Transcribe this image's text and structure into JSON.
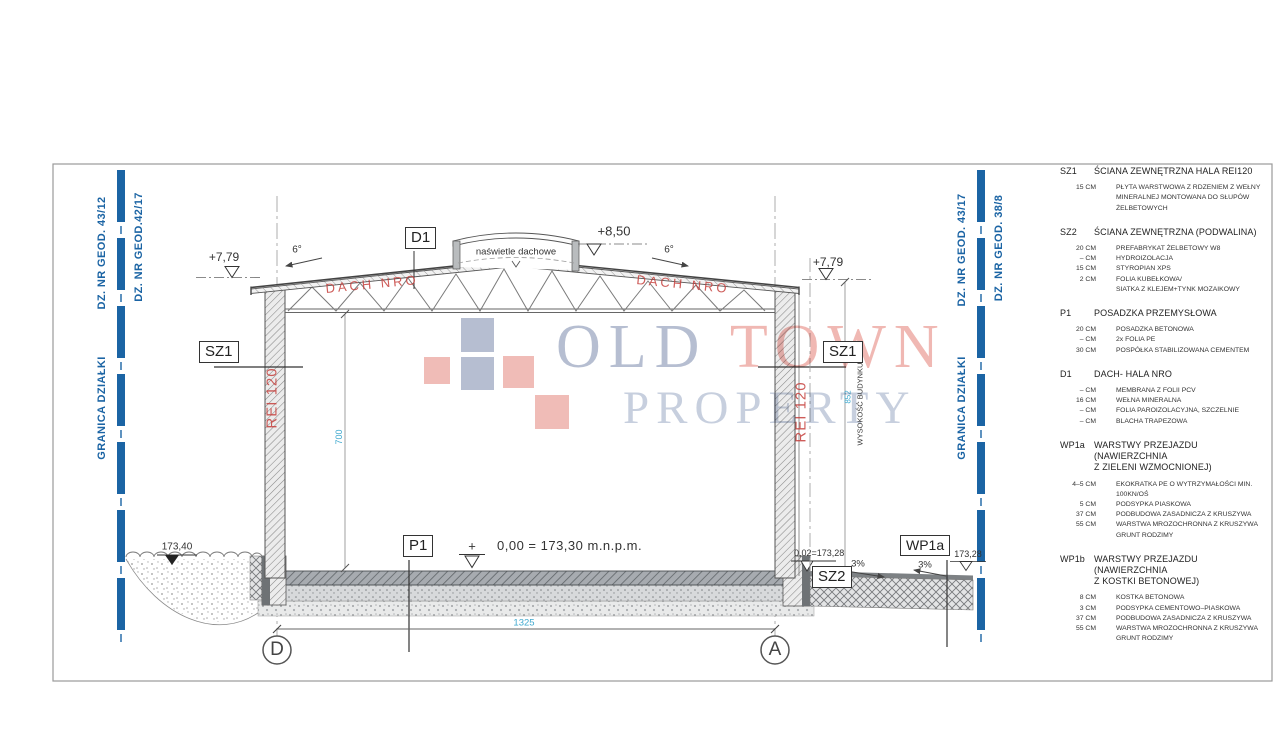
{
  "colors": {
    "boundary_blue": "#1b64a4",
    "dimension_cyan": "#3fa9cf",
    "annotation_red": "#c5403c",
    "watermark_blue": "#a9b3c9",
    "watermark_pink": "#eeaca6"
  },
  "boundaries": {
    "left": {
      "granica": "GRANICA DZIAŁKI",
      "parcel_a": "DZ. NR GEOD. 43/12",
      "parcel_b": "DZ. NR GEOD.42/17"
    },
    "right": {
      "granica": "GRANICA DZIAŁKI",
      "parcel_a": "DZ. NR GEOD. 43/17",
      "parcel_b": "DZ. NR GEOD. 38/8"
    }
  },
  "section": {
    "skylight": "naświetle dachowe",
    "ridge_level": "+8,50",
    "eave_level_left": "+7,79",
    "eave_level_right": "+7,79",
    "roof_slope_left": "6°",
    "roof_slope_right": "6°",
    "roof_label_left": "DACH NRO",
    "roof_label_right": "DACH NRO",
    "wall_fire_left": "REI 120",
    "wall_fire_right": "REI 120",
    "tag_d1": "D1",
    "tag_sz1_left": "SZ1",
    "tag_sz1_right": "SZ1",
    "tag_p1": "P1",
    "tag_sz2": "SZ2",
    "tag_wp1a": "WP1a",
    "floor_plus": "+",
    "floor_level": "0,00 = 173,30 m.n.p.m.",
    "grade_left": "173,40",
    "grade_right_wall": "0,02=173,28",
    "grade_right_edge": "173,28",
    "drive_slope_1": "3%",
    "drive_slope_2": "3%",
    "dim_clear_height": "700",
    "dim_building_height": "852",
    "dim_building_height_label": "WYSOKOŚĆ BUDYNKU",
    "dim_width": "1325",
    "grid_left": "D",
    "grid_right": "A"
  },
  "watermark": {
    "word1": "OLD",
    "word2": "TOWN",
    "line2": "PROPERTY"
  },
  "legend": {
    "sections": [
      {
        "id": "SZ1",
        "title": "ŚCIANA ZEWNĘTRZNA HALA REI120",
        "rows": [
          {
            "cm": "15 CM",
            "desc": "PŁYTA WARSTWOWA Z RDZENIEM Z WEŁNY\nMINERALNEJ MONTOWANA DO SŁUPÓW\nŻELBETOWYCH"
          }
        ]
      },
      {
        "id": "SZ2",
        "title": "ŚCIANA ZEWNĘTRZNA (PODWALINA)",
        "rows": [
          {
            "cm": "20 CM",
            "desc": "PREFABRYKAT ŻELBETOWY W8"
          },
          {
            "cm": "– CM",
            "desc": "HYDROIZOLACJA"
          },
          {
            "cm": "15 CM",
            "desc": "STYROPIAN XPS"
          },
          {
            "cm": "2 CM",
            "desc": "FOLIA KUBEŁKOWA/\nSIATKA Z KLEJEM+TYNK MOZAIKOWY"
          }
        ]
      },
      {
        "id": "P1",
        "title": "POSADZKA PRZEMYSŁOWA",
        "rows": [
          {
            "cm": "20 CM",
            "desc": "POSADZKA BETONOWA"
          },
          {
            "cm": "– CM",
            "desc": "2x FOLIA PE"
          },
          {
            "cm": "30 CM",
            "desc": "POSPÓŁKA STABILIZOWANA CEMENTEM"
          }
        ]
      },
      {
        "id": "D1",
        "title": "DACH- HALA NRO",
        "rows": [
          {
            "cm": "– CM",
            "desc": "MEMBRANA Z FOLII PCV"
          },
          {
            "cm": "16 CM",
            "desc": "WEŁNA MINERALNA"
          },
          {
            "cm": "– CM",
            "desc": "FOLIA PAROIZOLACYJNA, SZCZELNIE"
          },
          {
            "cm": "– CM",
            "desc": "BLACHA TRAPEZOWA"
          }
        ]
      },
      {
        "id": "WP1a",
        "title": "WARSTWY PRZEJAZDU (NAWIERZCHNIA\nZ ZIELENI WZMOCNIONEJ)",
        "rows": [
          {
            "cm": "4–5 CM",
            "desc": "EKOKRATKA PE O WYTRZYMAŁOŚCI MIN. 100KN/OŚ"
          },
          {
            "cm": "5 CM",
            "desc": "PODSYPKA PIASKOWA"
          },
          {
            "cm": "37 CM",
            "desc": "PODBUDOWA ZASADNICZA Z KRUSZYWA"
          },
          {
            "cm": "55 CM",
            "desc": "WARSTWA MROZOCHRONNA Z KRUSZYWA\nGRUNT RODZIMY"
          }
        ]
      },
      {
        "id": "WP1b",
        "title": "WARSTWY PRZEJAZDU (NAWIERZCHNIA\nZ KOSTKI BETONOWEJ)",
        "rows": [
          {
            "cm": "8 CM",
            "desc": "KOSTKA BETONOWA"
          },
          {
            "cm": "3 CM",
            "desc": "PODSYPKA CEMENTOWO–PIASKOWA"
          },
          {
            "cm": "37 CM",
            "desc": "PODBUDOWA ZASADNICZA Z KRUSZYWA"
          },
          {
            "cm": "55 CM",
            "desc": "WARSTWA MROZOCHRONNA Z KRUSZYWA\nGRUNT RODZIMY"
          }
        ]
      }
    ]
  }
}
